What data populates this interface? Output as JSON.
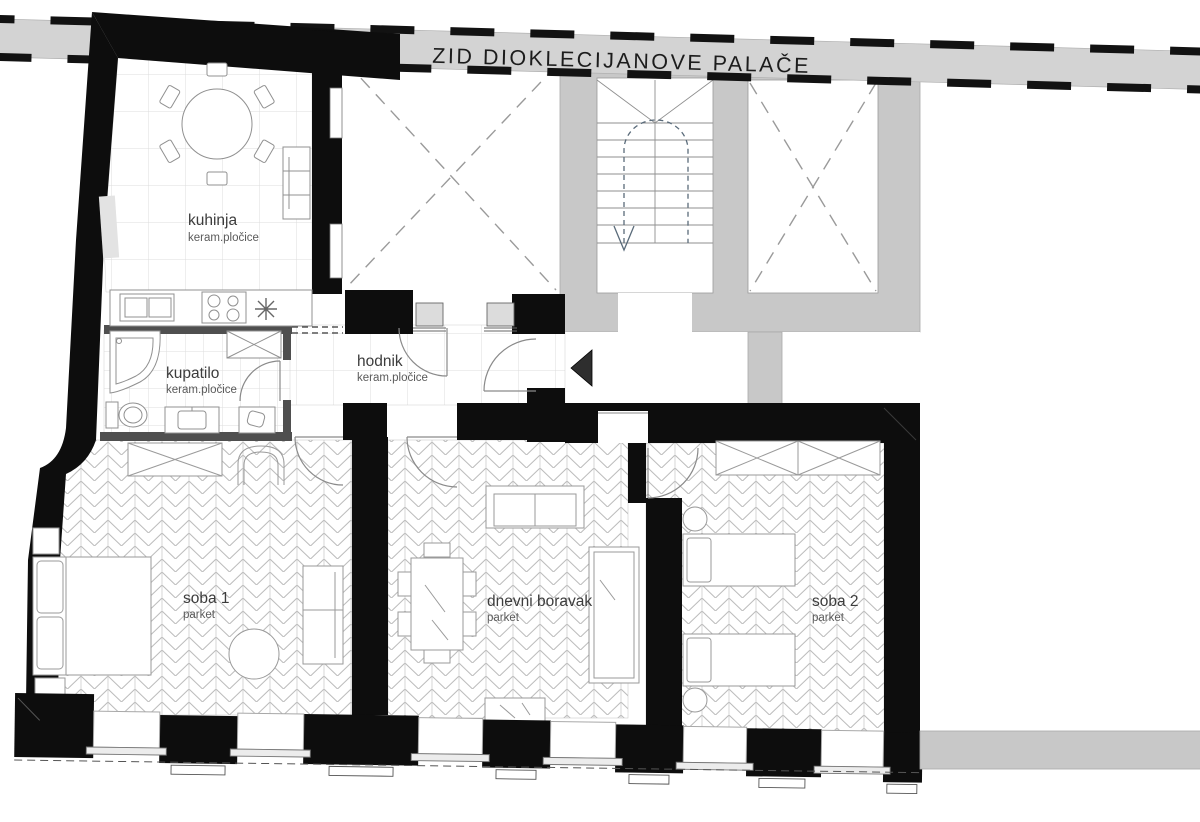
{
  "title": "ZID DIOKLECIJANOVE PALAČE",
  "rooms": {
    "kuhinja": {
      "name": "kuhinja",
      "floor": "keram.pločice"
    },
    "kupatilo": {
      "name": "kupatilo",
      "floor": "keram.pločice"
    },
    "hodnik": {
      "name": "hodnik",
      "floor": "keram.pločice"
    },
    "soba1": {
      "name": "soba 1",
      "floor": "parket"
    },
    "dnevni_boravak": {
      "name": "dnevni boravak",
      "floor": "parket"
    },
    "soba2": {
      "name": "soba 2",
      "floor": "parket"
    }
  },
  "icons": {
    "entrance_arrow": "filled triangle pointing left at apartment entrance",
    "stairs_arrow": "dashed U-path with arrow pointing down the stairs"
  },
  "colors": {
    "wall_black": "#0d0d0d",
    "communal_gray": "#c8c8c8",
    "band_gray": "#d3d3d3",
    "bathroom_wall_gray": "#4f4f4f",
    "label_text": "#3c3c3c"
  }
}
